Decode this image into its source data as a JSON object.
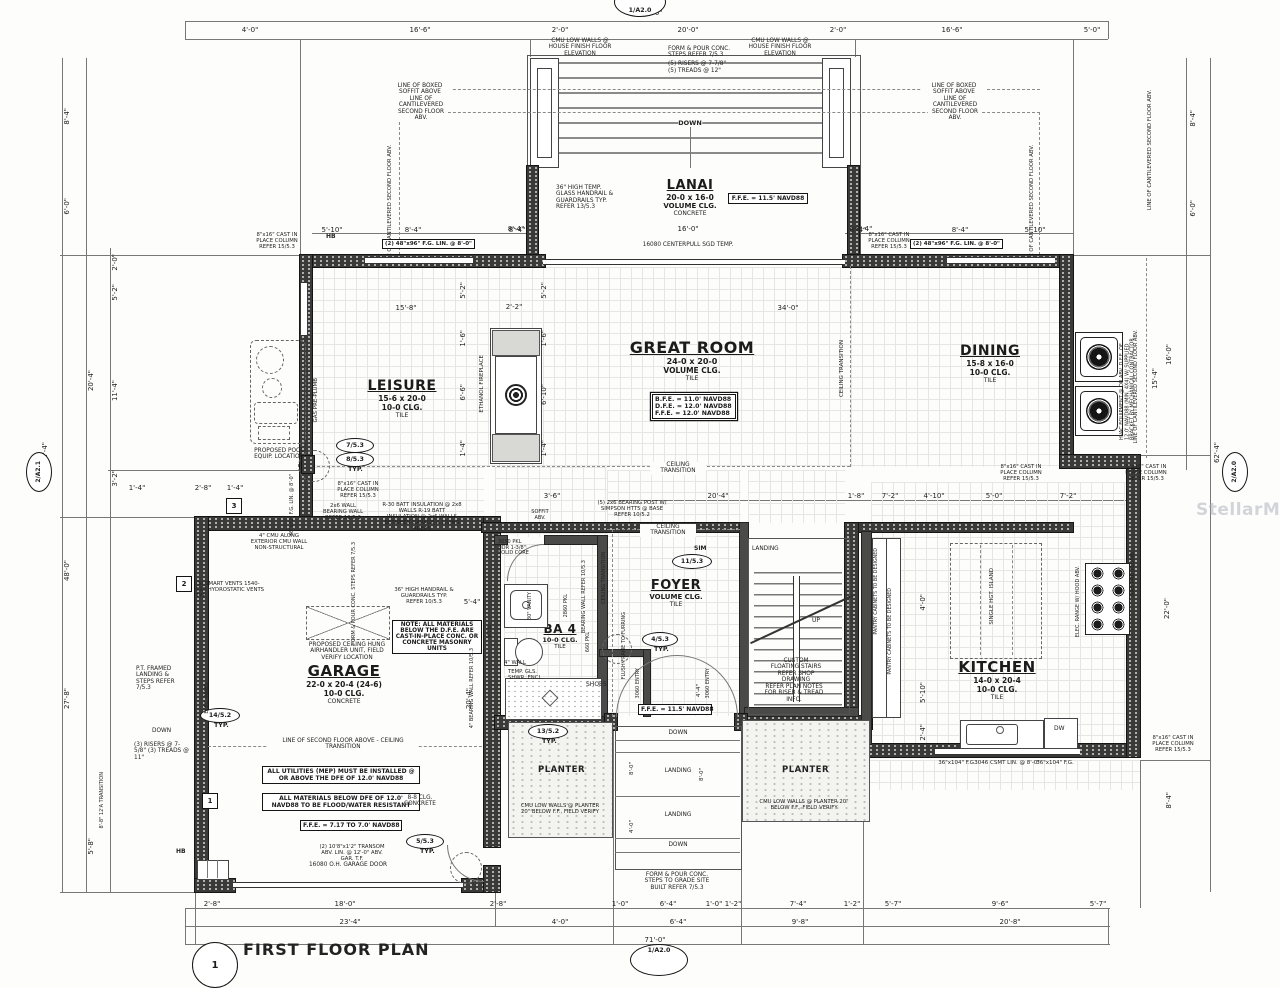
{
  "watermark": "StellarMLS",
  "sheet": {
    "title": "FIRST FLOOR PLAN",
    "bubble_top": "1/A2.0",
    "bubble_bottom": "1/A2.0",
    "bubble_left": "2/A2.1",
    "bubble_right": "2/A2.0",
    "scale_bubble": "1"
  },
  "r": {
    "lanai": {
      "name": "LANAI",
      "size": "20-0 x 16-0",
      "clg": "VOLUME CLG.",
      "floor": "CONCRETE"
    },
    "great": {
      "name": "GREAT ROOM",
      "size": "24-0 x 20-0",
      "clg": "VOLUME CLG.",
      "floor": "TILE"
    },
    "leisure": {
      "name": "LEISURE",
      "size": "15-6 x 20-0",
      "clg": "10-0 CLG.",
      "floor": "TILE"
    },
    "dining": {
      "name": "DINING",
      "size": "15-8 x 16-0",
      "clg": "10-0 CLG.",
      "floor": "TILE"
    },
    "garage": {
      "name": "GARAGE",
      "size": "22-0 x 20-4 (24-6)",
      "clg": "10-0 CLG.",
      "floor": "CONCRETE"
    },
    "foyer": {
      "name": "FOYER",
      "clg": "VOLUME CLG.",
      "floor": "TILE"
    },
    "kitchen": {
      "name": "KITCHEN",
      "size": "14-0 x 20-4",
      "clg": "10-0 CLG.",
      "floor": "TILE"
    },
    "ba4": {
      "name": "BA 4",
      "clg": "10-0 CLG.",
      "floor": "TILE"
    },
    "planter": "PLANTER",
    "shoes": "SHOES"
  },
  "fee": {
    "lanai": "F.F.E. = 11.5' NAVD88",
    "foyer": "F.F.E. = 11.5' NAVD88",
    "garage": "F.F.E. = 7.17 TO 7.0' NAVD88",
    "bfe": "B.F.E. = 11.0' NAVD88",
    "dfe": "D.F.E. = 12.0' NAVD88",
    "ffe": "F.F.E. = 12.0' NAVD88"
  },
  "n": {
    "cmu_house": "CMU LOW WALLS @ HOUSE FINISH FLOOR ELEVATION",
    "steps_form": "FORM & POUR CONC. STEPS REFER 7/5.3",
    "risers5": "(5) RISERS @ 7-7/8\"",
    "treads5": "(5) TREADS @ 12\"",
    "down": "DOWN",
    "up": "UP",
    "landing": "LANDING",
    "glass_rail": "36\" HIGH TEMP. GLASS HANDRAIL & GUARDRAILS TYP. REFER 13/5.3",
    "sgd": "16080 CENTERPULL SGD TEMP.",
    "soffit_line": "LINE OF BOXED SOFFIT ABOVE",
    "cant": "LINE OF CANTILEVERED SECOND FLOOR ABV.",
    "col": "8\"x16\" CAST IN PLACE COLUMN REFER 15/5.3",
    "fg48": "(2) 48\"x96\" F.G. LIN. @ 8'-0\"",
    "ct": "CEILING TRANSITION",
    "fireplace": "ETHANOL FIREPLACE",
    "pool": "PROPOSED POOL EQUIP. LOCATION",
    "gas": "GAS PRE-PLUMB",
    "fg3672": "36\"x72\" F.G. LIN. @ 8'-0\"",
    "hvac": "HVAC EQUIPMENT @ OR ABV. D.F.E. OF 12.0' NAVD88 (MIN. 4X4) W/ SUPPLIED BRACKET BY MECHANICAL CONTRACTOR",
    "vents": "(5) SMART VENTS 1540-510 HYDROSTATIC VENTS TYP.",
    "cmu4": "4\" CMU ALONG EXTERIOR CMU WALL NON-STRUCTURAL",
    "batt": "R-30 BATT INSULATION @ 2x8 WALLS R-19 BATT INSULATION @ 2x6 WALLS BETWEEN GARAGE & LIVING AREAS",
    "post": "(5) 2x6 BEARING POST W/ SIMPSON HTT5 @ BASE REFER 10/5.2",
    "wall26": "2x6 WALL BEARING WALL REFER 10/5.3",
    "rail36": "36\" HIGH HANDRAIL & GUARDRAILS TYP. REFER 10/5.3",
    "bw4": "4\" BEARING WALL REFER 10/5.3",
    "vto": "V.T.O.",
    "ahu": "PROPOSED CEILING HUNG AIRHANDLER UNIT, FIELD VERIFY LOCATION",
    "l2f": "LINE OF SECOND FLOOR ABOVE - CEILING TRANSITION",
    "note_mat": "NOTE: ALL MATERIALS BELOW THE D.F.E. ARE CAST-IN-PLACE CONC. OR CONCRETE MASONRY UNITS",
    "util": "ALL UTILITIES (MEP) MUST BE INSTALLED @ OR ABOVE THE DFE OF 12.0' NAVD88",
    "flood": "ALL MATERIALS BELOW DFE OF 12.0' NAVD88 TO BE FLOOD/WATER RESISTANT",
    "clg88": "8-8 CLG. CONCRETE",
    "transom": "(2) 10'8\"x1'2\" TRANSOM ABV. LIN. @ 12'-0\" ABV. GAR. T.F.",
    "gdoor": "16080 O.H. GARAGE DOOR",
    "panel": "ELEC. PANEL",
    "pt": "P.T. FRAMED LANDING & STEPS REFER 7/5.3",
    "risers3": "(3) RISERS @ 7-5/8\" (3) TREADS @ 11\"",
    "hb": "HB",
    "vanity": "30\" VANITY",
    "wall4": "4\" WALL",
    "shwr": "TEMP. GLS. SHWR. ENCL.",
    "d3050": "3050 PKL HDR 1-3/8\" SOLID CORE",
    "d2860": "2860 PKL",
    "d660": "660 PKL",
    "bwall": "BEARING WALL REFER 10/5.3",
    "flush": "FLUSH FRAME TO FURRING",
    "entry": "3060 ENTRY",
    "stairs": "CUSTOM FLOATING STAIRS REFER SHOP DRAWING",
    "rt_info": "REFER PLAN NOTES FOR RISER & TREAD INFO.",
    "w2": "REFER SECOND FLR. PLAN FOR WINDOW SIZES",
    "cmu_planter": "CMU LOW WALLS @ PLANTER 20\" BELOW F.F., FIELD VERIFY",
    "grade": "FORM & POUR CONC. STEPS TO GRADE SITE BUILT REFER 7/5.3",
    "island": "SINGLE HGT. ISLAND",
    "range": "ELEC. RANGE W/ HOOD ABV.",
    "dw": "DW",
    "pantry": "PANTRY CABINETS TO BE DESIGNED",
    "fg36104": "36\"x104\" F.G.",
    "csmt": "3046 CSMT LIN. @ 8'-0\"",
    "soffit_abv": "SOFFIT ABV."
  },
  "c": {
    "c7": "7/5.3",
    "c8": "8/5.3",
    "c14": "14/5.2",
    "c5": "5/5.3",
    "c13": "13/5.2",
    "c11": "11/5.3",
    "c4": "4/5.3",
    "sim": "SIM",
    "typ": "TYP.",
    "m1": "1",
    "m2": "2",
    "m3": "3"
  },
  "d": {
    "d71": "71'-0\"",
    "d62_4": "62'-4\"",
    "d4_0": "4'-0\"",
    "d16_6": "16'-6\"",
    "d2_0": "2'-0\"",
    "d20_0": "20'-0\"",
    "d5_0": "5'-0\"",
    "d5_10": "5'-10\"",
    "d8_4": "8'-4\"",
    "d16_0": "16'-0\"",
    "d6_0": "6'-0\"",
    "d20_4": "20'-4\"",
    "d48_0": "48'-0\"",
    "d27_8": "27'-8\"",
    "d5_8": "5'-8\"",
    "d5_2": "5'-2\"",
    "d11_4": "11'-4\"",
    "d3_2": "3'-2\"",
    "d1_4": "1'-4\"",
    "d2_8": "2'-8\"",
    "d18_0": "18'-0\"",
    "d23_4": "23'-4\"",
    "d1_0": "1'-0\"",
    "d6_4": "6'-4\"",
    "d1_2": "1'-2\"",
    "d7_4": "7'-4\"",
    "d5_7": "5'-7\"",
    "d9_6": "9'-6\"",
    "d9_8": "9'-8\"",
    "d20_8": "20'-8\"",
    "d15_8": "15'-8\"",
    "d34_0": "34'-0\"",
    "d2_2": "2'-2\"",
    "d1_6": "1'-6\"",
    "d6_6": "6'-6\"",
    "d6_10": "6'-10\"",
    "d3_6": "3'-6\"",
    "d1_8": "1'-8\"",
    "d7_2": "7'-2\"",
    "d4_10": "4'-10\"",
    "d15_4": "15'-4\"",
    "d22_0": "22'-0\"",
    "d8_0": "8'-0\"",
    "d4_4": "4'-4\"",
    "d5_4": "5'-4\"",
    "d2_4": "2'-4\"",
    "d8_8t": "8'-8\" 12'A TRANSITION"
  }
}
